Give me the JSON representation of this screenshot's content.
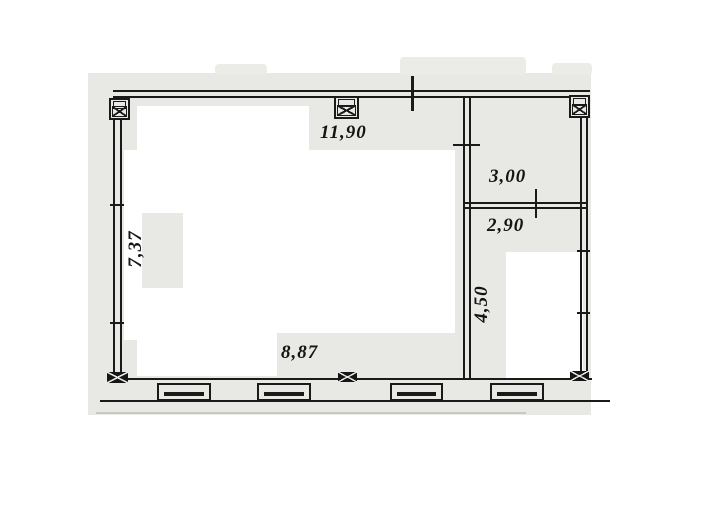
{
  "drawing": {
    "kind": "scanned architectural floor plan",
    "colors": {
      "paper": "#ffffff",
      "scan_background": "#e8e8e5",
      "ink": "#1a1a1a"
    },
    "dims": {
      "top_width": "11,90",
      "right_room_width": "3,00",
      "lower_room_width": "2,90",
      "left_wall_height": "7,37",
      "right_room_height": "4,50",
      "bottom_width": "8,87"
    },
    "symbols": {
      "column": "column-icon",
      "window": "window-segment",
      "opening_tick": "opening-tick"
    }
  }
}
